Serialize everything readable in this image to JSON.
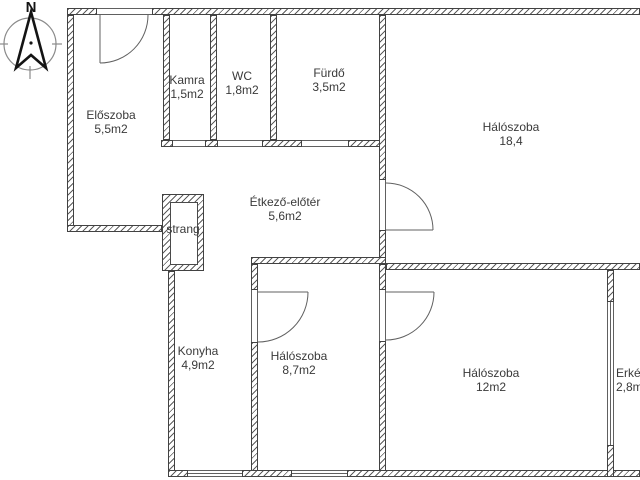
{
  "compass": {
    "north_label": "N"
  },
  "rooms": {
    "eloszoba": {
      "name": "Előszoba",
      "area": "5,5m2"
    },
    "kamra": {
      "name": "Kamra",
      "area": "1,5m2"
    },
    "wc": {
      "name": "WC",
      "area": "1,8m2"
    },
    "furdo": {
      "name": "Fürdő",
      "area": "3,5m2"
    },
    "halo_nagy": {
      "name": "Hálószoba",
      "area": "18,4"
    },
    "etkezo": {
      "name": "Étkező-előtér",
      "area": "5,6m2"
    },
    "strang": {
      "name": "strang"
    },
    "konyha": {
      "name": "Konyha",
      "area": "4,9m2"
    },
    "halo_kozep": {
      "name": "Hálószoba",
      "area": "8,7m2"
    },
    "halo_also": {
      "name": "Hálószoba",
      "area": "12m2"
    },
    "erkely": {
      "name": "Erkély",
      "area": "2,8m2"
    }
  },
  "colors": {
    "wall_line": "#424242",
    "hatch": "#5d5d5d",
    "door_line": "#606060",
    "text": "#3a3a3a",
    "background": "#ffffff"
  }
}
